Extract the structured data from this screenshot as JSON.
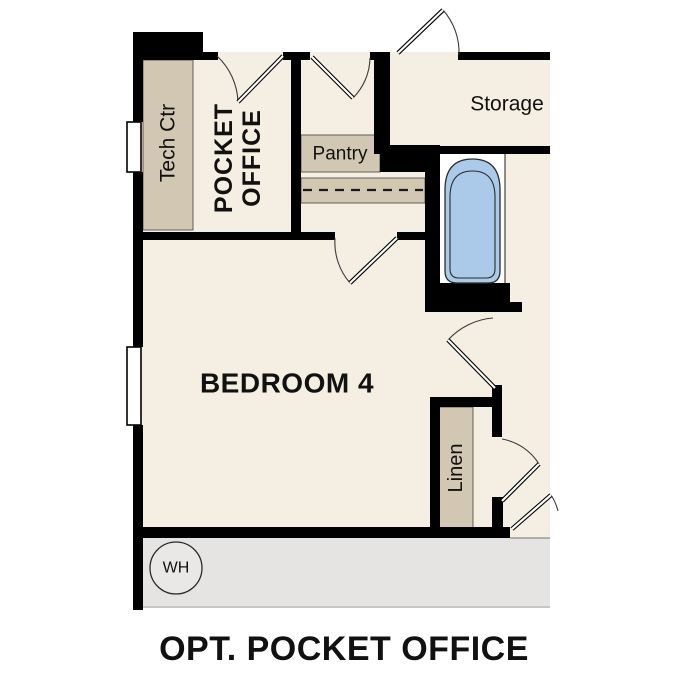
{
  "title": "OPT. POCKET OFFICE",
  "labels": {
    "tech_ctr": "Tech Ctr",
    "pocket_office_line1": "POCKET",
    "pocket_office_line2": "OFFICE",
    "pantry": "Pantry",
    "storage": "Storage",
    "bedroom": "BEDROOM 4",
    "linen": "Linen",
    "water_heater": "WH"
  },
  "colors": {
    "wall": "#000000",
    "floor": "#f5eee2",
    "cabinet": "#d2c7b2",
    "tub_fill": "#abc9e8",
    "garage_floor": "#e5e4e2",
    "background": "#ffffff"
  }
}
